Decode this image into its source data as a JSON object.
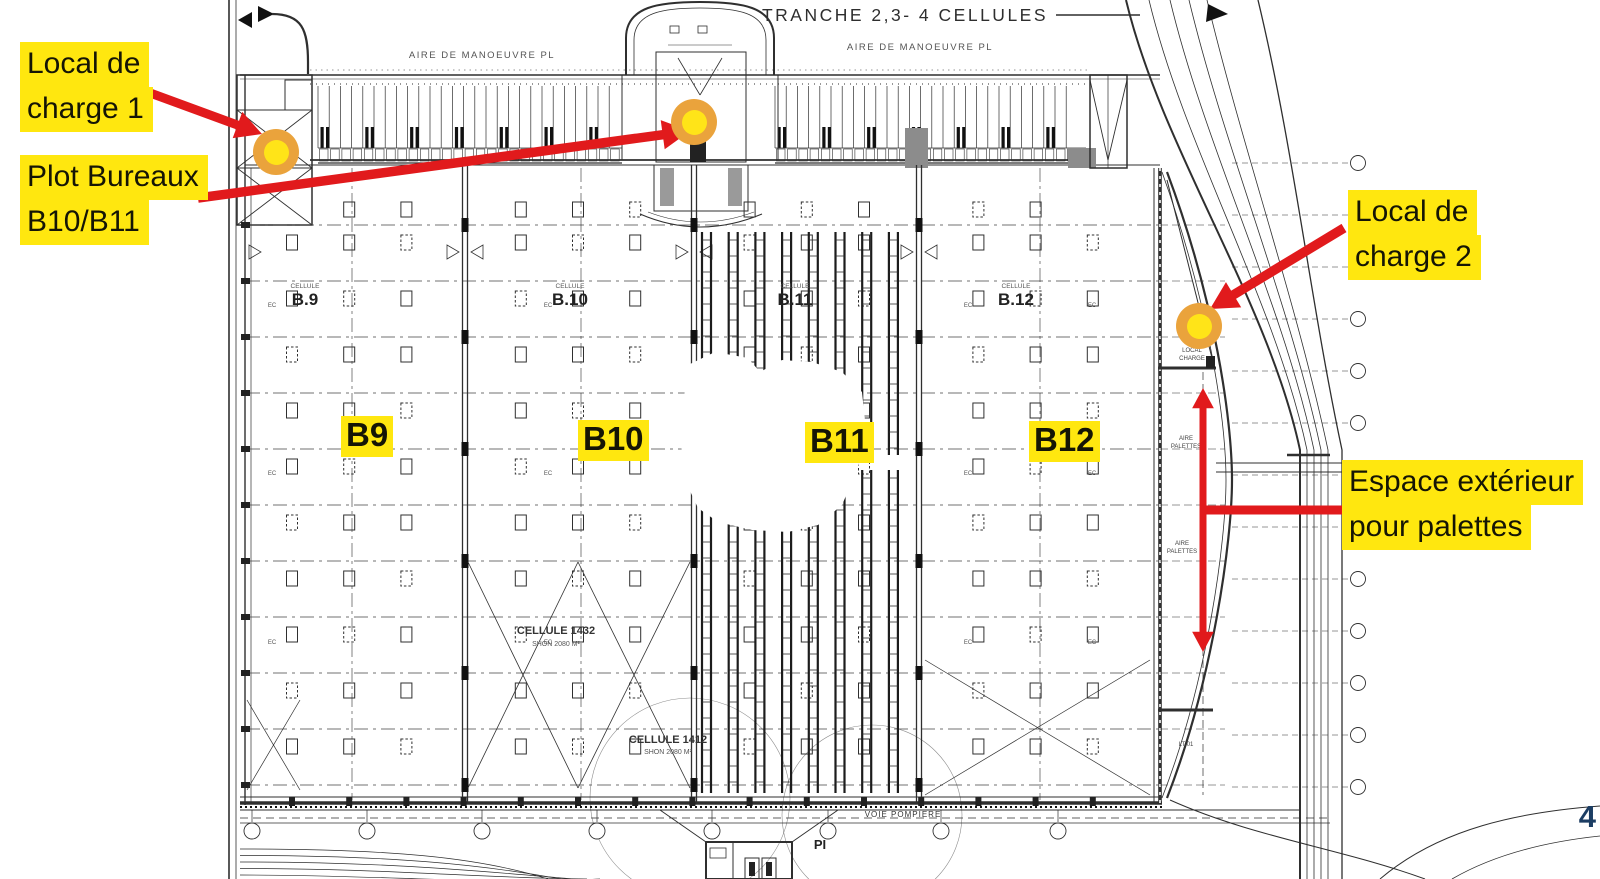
{
  "page": {
    "number": "4"
  },
  "colors": {
    "highlight_yellow": "#ffe70f",
    "annotation_red": "#e11a1c",
    "marker_ring_orange": "#eaa33c",
    "marker_center_yellow": "#ffe418",
    "page_number_navy": "#1c3d63",
    "plan_ink": "#2f2f2f"
  },
  "callouts": {
    "local_charge_1": {
      "lines": [
        "Local de",
        "charge 1"
      ]
    },
    "plot_bureaux": {
      "lines": [
        "Plot Bureaux",
        "B10/B11"
      ]
    },
    "local_charge_2": {
      "lines": [
        "Local de",
        "charge 2"
      ]
    },
    "espace_exterieur": {
      "lines": [
        "Espace extérieur",
        "pour palettes"
      ]
    }
  },
  "cell_tags": [
    "B9",
    "B10",
    "B11",
    "B12"
  ],
  "plan": {
    "title": "TRANCHE 2,3- 4 CELLULES",
    "maneuver_area_label": "AIRE DE MANOEUVRE PL",
    "cells": [
      {
        "small": "CELLULE",
        "name": "B.9"
      },
      {
        "small": "CELLULE",
        "name": "B.10"
      },
      {
        "small": "CELLULE",
        "name": "B.11"
      },
      {
        "small": "CELLULE",
        "name": "B.12"
      }
    ],
    "sub_cells": [
      {
        "name": "CELLULE 1432",
        "area": "SHON 2080 M²"
      },
      {
        "name": "CELLULE 1412",
        "area": "SHON 2080 M²"
      }
    ],
    "fire_road_label": "VOIE POMPIERE",
    "hydrant_label": "PI",
    "local_charge_room": [
      "LOCAL",
      "CHARGE"
    ],
    "pallet_area_label": [
      "AIRE",
      "PALETTES"
    ],
    "lt_label": "LT 01",
    "ec_label": "EC"
  }
}
